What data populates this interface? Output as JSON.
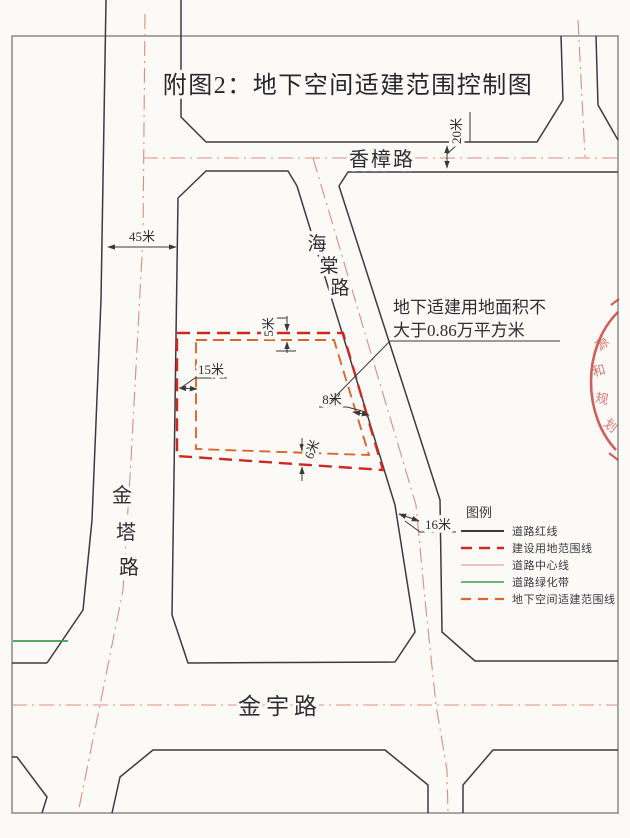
{
  "figure": {
    "title": "附图2：地下空间适建范围控制图"
  },
  "annotation": {
    "line1": "地下适建用地面积不",
    "line2": "大于0.86万平方米"
  },
  "roads": {
    "xiangzhang": {
      "name": "香樟路"
    },
    "haitang": {
      "name": "海棠路",
      "chars": [
        "海",
        "棠",
        "路"
      ]
    },
    "jinta": {
      "name": "金塔路",
      "chars": [
        "金",
        "塔",
        "路"
      ]
    },
    "jinyu": {
      "name": "金宇路"
    }
  },
  "dimensions": {
    "xiangzhang_width": "20米",
    "jinta_width": "45米",
    "top_setback": "5米",
    "left_setback": "15米",
    "right_setback": "8米",
    "bottom_setback": "6米",
    "haitang_half_width": "16米"
  },
  "legend": {
    "title": "图例",
    "items": [
      {
        "label": "道路红线",
        "style": "solid-black",
        "color": "#3b3b42"
      },
      {
        "label": "建设用地范围线",
        "style": "dashed-red",
        "color": "#cc2a20"
      },
      {
        "label": "道路中心线",
        "style": "solid-pink",
        "color": "#dc8d82"
      },
      {
        "label": "道路绿化带",
        "style": "solid-green",
        "color": "#3f9d53"
      },
      {
        "label": "地下空间适建范围线",
        "style": "dashed-orange",
        "color": "#d9662e"
      }
    ]
  },
  "stamp": {
    "chars": [
      "源",
      "和",
      "规",
      "划"
    ],
    "color": "#c23b35"
  },
  "colors": {
    "road_line": "#3b3b42",
    "center_line": "#dc8d82",
    "red_boundary": "#cc2a20",
    "underground_boundary": "#d9662e",
    "green_belt": "#3f9d53",
    "dimension": "#3a3a3a",
    "paper": "#fbfaf7"
  }
}
